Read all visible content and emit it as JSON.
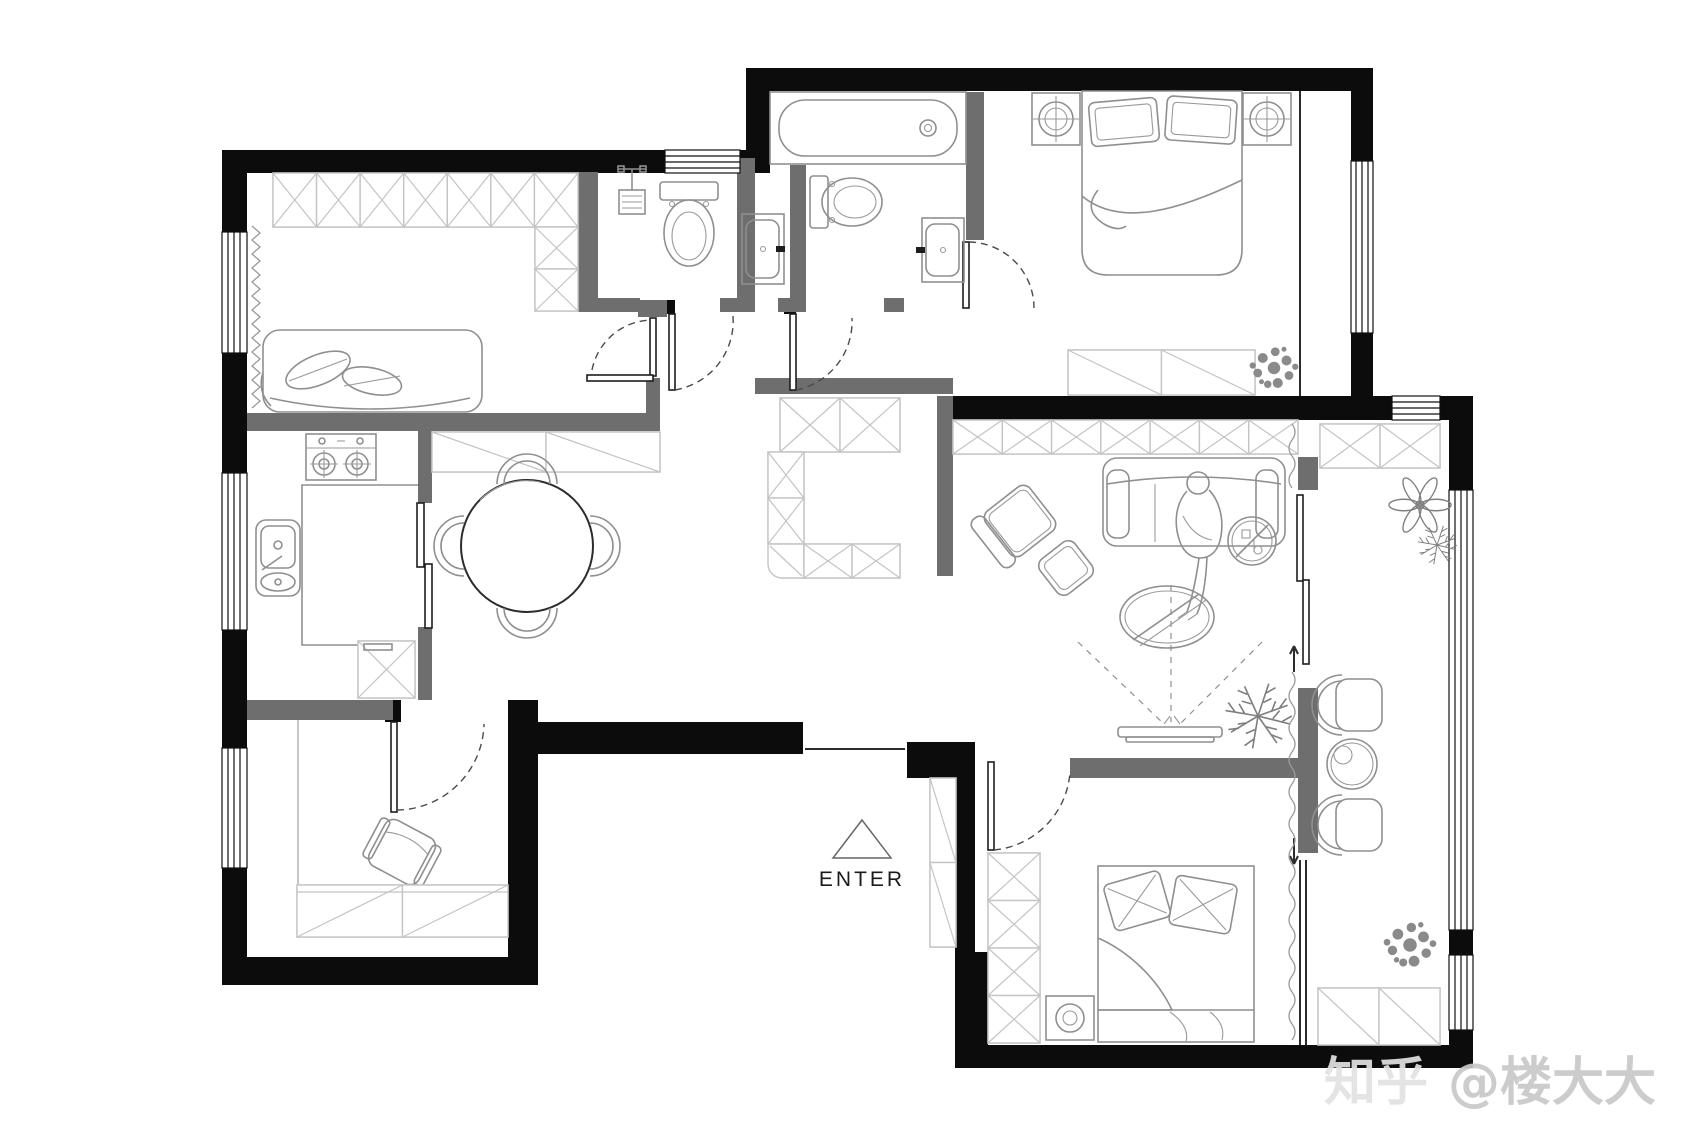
{
  "labels": {
    "enter": "ENTER"
  },
  "watermark": {
    "site": "知乎",
    "author": "@楼大大"
  },
  "colors": {
    "background": "#ffffff",
    "exterior_wall": "#0c0c0c",
    "partition_wall": "#6e6e6e",
    "furniture_line": "#8f8f8f",
    "cabinet_line": "#c4c4c4",
    "door_arc": "#4a4a4a",
    "plant": "#7f7f7f",
    "enter_text": "#1b1b1b",
    "watermark_text": "#c8c8c8"
  },
  "icons": [
    "wardrobe-icon",
    "sofa-icon",
    "cushion-icon",
    "curtain-icon",
    "stove-icon",
    "kitchen-sink-icon",
    "washing-machine-icon",
    "dining-table-icon",
    "dining-chair-icon",
    "sideboard-icon",
    "shower-icon",
    "toilet-icon",
    "bathtub-icon",
    "vanity-sink-icon",
    "double-bed-icon",
    "nightstand-icon",
    "dresser-icon",
    "plant-icon",
    "tv-icon",
    "projection-cone-icon",
    "coffee-table-icon",
    "armchair-icon",
    "ottoman-icon",
    "side-cart-icon",
    "person-icon",
    "balcony-chair-icon",
    "balcony-table-icon",
    "storage-cabinet-icon",
    "shoe-cabinet-icon",
    "door-swing-icon",
    "sliding-door-icon",
    "window-icon",
    "entry-arrow-icon"
  ]
}
